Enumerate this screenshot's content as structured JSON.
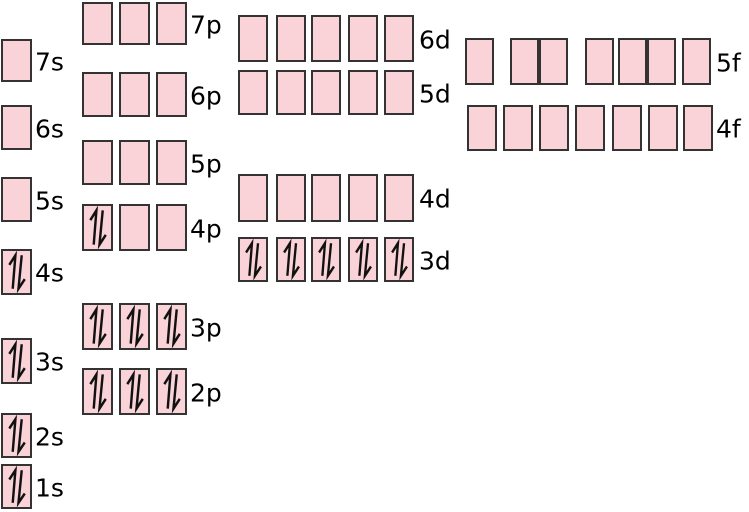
{
  "colors": {
    "background": "#ffffff",
    "box_fill": "#fad3d8",
    "box_border": "#333333",
    "arrow": "#111111",
    "label_text": "#000000"
  },
  "diagram": {
    "type": "electron-orbital-energy-diagram",
    "electron_pair_symbol": "paired spin-up / spin-down half-arrows",
    "orbitals": [
      {
        "label": "1s",
        "electrons_per_box": [
          2
        ]
      },
      {
        "label": "2s",
        "electrons_per_box": [
          2
        ]
      },
      {
        "label": "2p",
        "electrons_per_box": [
          2,
          2,
          2
        ]
      },
      {
        "label": "3s",
        "electrons_per_box": [
          2
        ]
      },
      {
        "label": "3p",
        "electrons_per_box": [
          2,
          2,
          2
        ]
      },
      {
        "label": "4s",
        "electrons_per_box": [
          2
        ]
      },
      {
        "label": "3d",
        "electrons_per_box": [
          2,
          2,
          2,
          2,
          2
        ]
      },
      {
        "label": "4p",
        "electrons_per_box": [
          2,
          0,
          0
        ]
      },
      {
        "label": "5s",
        "electrons_per_box": [
          0
        ]
      },
      {
        "label": "4d",
        "electrons_per_box": [
          0,
          0,
          0,
          0,
          0
        ]
      },
      {
        "label": "5p",
        "electrons_per_box": [
          0,
          0,
          0
        ]
      },
      {
        "label": "6s",
        "electrons_per_box": [
          0
        ]
      },
      {
        "label": "4f",
        "electrons_per_box": [
          0,
          0,
          0,
          0,
          0,
          0,
          0
        ]
      },
      {
        "label": "5d",
        "electrons_per_box": [
          0,
          0,
          0,
          0,
          0
        ]
      },
      {
        "label": "6p",
        "electrons_per_box": [
          0,
          0,
          0
        ]
      },
      {
        "label": "7s",
        "electrons_per_box": [
          0
        ]
      },
      {
        "label": "5f",
        "electrons_per_box": [
          0,
          0,
          0,
          0,
          0,
          0,
          0
        ]
      },
      {
        "label": "6d",
        "electrons_per_box": [
          0,
          0,
          0,
          0,
          0
        ]
      },
      {
        "label": "7p",
        "electrons_per_box": [
          0,
          0,
          0
        ]
      }
    ],
    "layout": {
      "canvas": {
        "width": 749,
        "height": 512
      },
      "rows": {
        "7p": {
          "y": 2,
          "h": 43,
          "box_w": 31,
          "box_x": [
            82,
            119,
            156
          ],
          "label_x": 190
        },
        "7s": {
          "y": 39,
          "h": 43,
          "box_w": 31,
          "box_x": [
            1
          ],
          "label_x": 35
        },
        "6p": {
          "y": 72,
          "h": 45,
          "box_w": 31,
          "box_x": [
            82,
            119,
            156
          ],
          "label_x": 190
        },
        "6s": {
          "y": 105,
          "h": 45,
          "box_w": 31,
          "box_x": [
            1
          ],
          "label_x": 35
        },
        "5p": {
          "y": 140,
          "h": 45,
          "box_w": 31,
          "box_x": [
            82,
            119,
            156
          ],
          "label_x": 190
        },
        "5s": {
          "y": 177,
          "h": 45,
          "box_w": 31,
          "box_x": [
            1
          ],
          "label_x": 35
        },
        "4p": {
          "y": 204,
          "h": 47,
          "box_w": 31,
          "box_x": [
            82,
            119,
            156
          ],
          "label_x": 190
        },
        "4s": {
          "y": 249,
          "h": 46,
          "box_w": 31,
          "box_x": [
            1
          ],
          "label_x": 35
        },
        "3p": {
          "y": 303,
          "h": 47,
          "box_w": 31,
          "box_x": [
            82,
            119,
            156
          ],
          "label_x": 190
        },
        "3s": {
          "y": 338,
          "h": 46,
          "box_w": 31,
          "box_x": [
            1
          ],
          "label_x": 35
        },
        "2p": {
          "y": 368,
          "h": 47,
          "box_w": 31,
          "box_x": [
            82,
            119,
            156
          ],
          "label_x": 190
        },
        "2s": {
          "y": 413,
          "h": 45,
          "box_w": 31,
          "box_x": [
            1
          ],
          "label_x": 35
        },
        "1s": {
          "y": 464,
          "h": 45,
          "box_w": 31,
          "box_x": [
            1
          ],
          "label_x": 35
        },
        "6d": {
          "y": 15,
          "h": 47,
          "box_w": 30,
          "box_x": [
            238,
            276,
            311,
            348,
            384
          ],
          "label_x": 419
        },
        "5d": {
          "y": 70,
          "h": 45,
          "box_w": 30,
          "box_x": [
            238,
            276,
            311,
            348,
            384
          ],
          "label_x": 419
        },
        "4d": {
          "y": 174,
          "h": 48,
          "box_w": 30,
          "box_x": [
            238,
            276,
            311,
            348,
            384
          ],
          "label_x": 419
        },
        "3d": {
          "y": 237,
          "h": 45,
          "box_w": 30,
          "box_x": [
            238,
            276,
            311,
            348,
            384
          ],
          "label_x": 419
        },
        "5f": {
          "y": 38,
          "h": 47,
          "box_w": 29,
          "box_x": [
            465,
            510,
            539,
            585,
            618,
            647,
            682
          ],
          "label_x": 716
        },
        "4f": {
          "y": 105,
          "h": 46,
          "box_w": 30,
          "box_x": [
            467,
            503,
            539,
            575,
            612,
            648,
            683
          ],
          "label_x": 716
        }
      }
    }
  }
}
